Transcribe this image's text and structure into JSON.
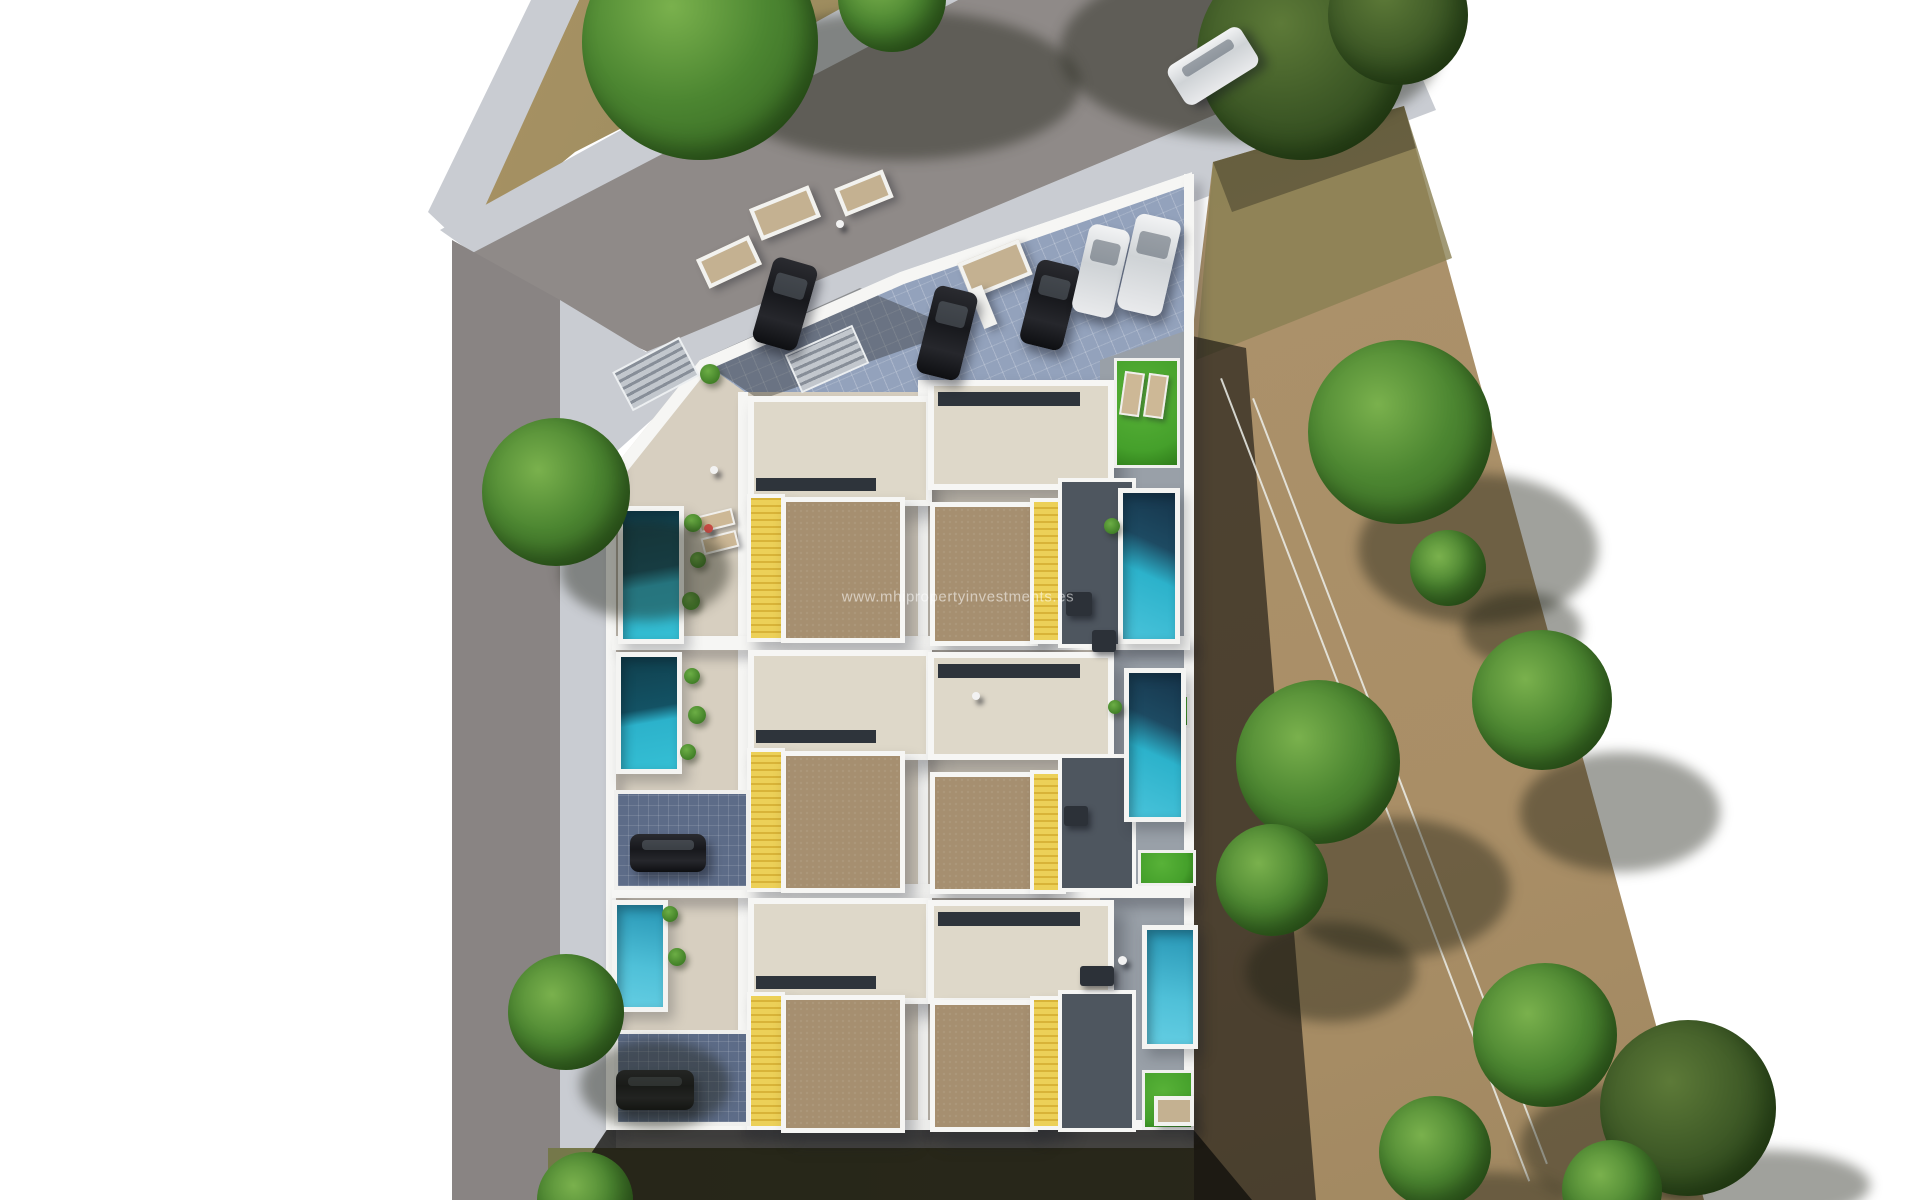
{
  "watermark": {
    "text": "www.mhipropertyinvestments.es"
  },
  "palette": {
    "bg": "#ffffff",
    "sidewalk": "#c9ccd2",
    "road": "#8f8a88",
    "road_dark": "#898483",
    "paving": "#93a2bc",
    "terrace": "#d7cfc0",
    "terrace_light": "#ded8c9",
    "roof_brown": "#a68f70",
    "deck_yellow": "#ecd058",
    "pool_bright": "#2cb2cb",
    "pool_dark": "#10404e",
    "grass": "#45a02b",
    "field": "#ab916a",
    "field_olive": "#8a7f53",
    "tree": "#4c8631",
    "tree_dark": "#2e5a1d",
    "wall": "#f6f6f4",
    "car_dark": "#17181c",
    "car_white": "#e9eaec",
    "watermark_color": "rgba(255,255,255,0.55)"
  },
  "scene": {
    "canvas": {
      "width": 1920,
      "height": 1200
    },
    "items": [
      {
        "n": "dirt-patch-top",
        "c": "dirt",
        "clip": "polygon(579px 0px, 872px 0px, 575px 152px, 468px 240px)"
      },
      {
        "n": "sidewalk-top-left",
        "c": "sidewalk",
        "clip": "polygon(531px 0px, 579px 0px, 466px 248px, 428px 212px)"
      },
      {
        "n": "sidewalk-upper",
        "c": "sidewalk",
        "clip": "polygon(856px 0px, 958px 0px, 480px 258px, 440px 230px)"
      },
      {
        "n": "road-diagonal",
        "c": "road",
        "clip": "polygon(958px 0px, 1396px 0px, 1404px 36px, 648px 352px, 455px 262px)"
      },
      {
        "n": "road-left-vertical",
        "c": "road2",
        "clip": "polygon(452px 240px, 560px 300px, 560px 1200px, 452px 1200px)"
      },
      {
        "n": "sidewalk-lower-diagonal",
        "c": "sidewalk",
        "clip": "polygon(1404px 36px, 1436px 110px, 676px 398px, 646px 352px)"
      },
      {
        "n": "sidewalk-left-vertical",
        "c": "sidewalk",
        "clip": "polygon(560px 300px, 646px 352px, 676px 398px, 616px 452px, 616px 1200px, 560px 1200px)"
      },
      {
        "n": "dirt-field",
        "c": "field",
        "clip": "polygon(1213px 162px, 1404px 106px, 1704px 1200px, 1194px 1200px, 1192px 336px)"
      },
      {
        "n": "field-olive-patch",
        "c": "field-olive",
        "clip": "polygon(1213px 162px, 1404px 106px, 1452px 258px, 1196px 360px)"
      },
      {
        "n": "field-top-shadow",
        "c": "shade",
        "clip": "polygon(1213px 162px, 1404px 106px, 1416px 148px, 1232px 212px)"
      },
      {
        "n": "field-west-wall-shadow",
        "c": "shade-deep",
        "clip": "polygon(1192px 336px, 1246px 348px, 1316px 1200px, 1194px 1200px)"
      },
      {
        "n": "field-fence-line",
        "c": "fence",
        "x": 1222,
        "y": 378,
        "w": 860,
        "h": 2,
        "r": 69
      },
      {
        "n": "field-fence-line",
        "c": "fence",
        "x": 1254,
        "y": 398,
        "w": 820,
        "h": 2,
        "r": 69
      },
      {
        "n": "tree-shadow",
        "c": "tshadow",
        "x": 1060,
        "y": -40,
        "w": 380,
        "h": 180
      },
      {
        "n": "tree-shadow",
        "c": "tshadow",
        "x": 1358,
        "y": 474,
        "w": 240,
        "h": 150
      },
      {
        "n": "tree-shadow",
        "c": "tshadow",
        "x": 1462,
        "y": 592,
        "w": 120,
        "h": 74
      },
      {
        "n": "tree-shadow",
        "c": "tshadow",
        "x": 1280,
        "y": 818,
        "w": 230,
        "h": 140
      },
      {
        "n": "tree-shadow",
        "c": "tshadow",
        "x": 1246,
        "y": 922,
        "w": 170,
        "h": 100
      },
      {
        "n": "tree-shadow",
        "c": "tshadow",
        "x": 1520,
        "y": 752,
        "w": 200,
        "h": 120
      },
      {
        "n": "tree-shadow",
        "c": "tshadow",
        "x": 1520,
        "y": 1086,
        "w": 210,
        "h": 120
      },
      {
        "n": "tree-shadow",
        "c": "tshadow",
        "x": 1410,
        "y": 1172,
        "w": 160,
        "h": 56
      },
      {
        "n": "tree-shadow",
        "c": "tshadow",
        "x": 1660,
        "y": 1150,
        "w": 210,
        "h": 70
      },
      {
        "n": "field-tree",
        "c": "tree darktone",
        "x": 1197,
        "y": -50,
        "w": 210,
        "h": 210
      },
      {
        "n": "field-tree",
        "c": "tree darktone",
        "x": 1328,
        "y": -55,
        "w": 140,
        "h": 140
      },
      {
        "n": "field-tree",
        "c": "tree",
        "x": 1308,
        "y": 340,
        "w": 184,
        "h": 184
      },
      {
        "n": "field-tree",
        "c": "tree",
        "x": 1410,
        "y": 530,
        "w": 76,
        "h": 76
      },
      {
        "n": "field-tree",
        "c": "tree",
        "x": 1236,
        "y": 680,
        "w": 164,
        "h": 164
      },
      {
        "n": "field-tree",
        "c": "tree",
        "x": 1216,
        "y": 824,
        "w": 112,
        "h": 112
      },
      {
        "n": "field-tree",
        "c": "tree",
        "x": 1472,
        "y": 630,
        "w": 140,
        "h": 140
      },
      {
        "n": "field-tree",
        "c": "tree",
        "x": 1473,
        "y": 963,
        "w": 144,
        "h": 144
      },
      {
        "n": "field-tree",
        "c": "tree",
        "x": 1379,
        "y": 1096,
        "w": 112,
        "h": 112
      },
      {
        "n": "field-tree",
        "c": "tree darktone",
        "x": 1600,
        "y": 1020,
        "w": 176,
        "h": 176
      },
      {
        "n": "field-tree",
        "c": "tree",
        "x": 1562,
        "y": 1140,
        "w": 100,
        "h": 100
      },
      {
        "n": "grass-strip-bottom",
        "c": "grassland",
        "clip": "polygon(548px 1148px, 1194px 1148px, 1194px 1200px, 548px 1200px)"
      },
      {
        "n": "complex-south-shadow",
        "c": "shade-strong",
        "clip": "polygon(608px 1128px, 1192px 1128px, 1252px 1200px, 560px 1200px)"
      },
      {
        "n": "complex-plot",
        "c": "terrace-base",
        "clip": "polygon(612px 470px, 700px 360px, 900px 272px, 1192px 172px, 1192px 1130px, 612px 1130px)"
      },
      {
        "n": "parking-paving",
        "c": "paving",
        "clip": "polygon(700px 360px, 900px 272px, 1192px 172px, 1192px 356px, 1100px 392px, 745px 392px)"
      },
      {
        "n": "east-garden-apron",
        "c": "apron",
        "clip": "polygon(1100px 360px, 1188px 330px, 1188px 1126px, 1100px 1126px)"
      },
      {
        "n": "parking-tree-shade",
        "c": "shade",
        "clip": "polygon(700px 360px, 860px 288px, 960px 330px, 760px 400px)"
      },
      {
        "n": "boundary-wall-top",
        "c": "wall-line",
        "clip": "polygon(612px 470px, 700px 360px, 900px 272px, 1192px 172px, 1192px 184px, 904px 284px, 708px 370px, 622px 478px)"
      },
      {
        "n": "stairs",
        "c": "stairs",
        "x": 618,
        "y": 352,
        "w": 72,
        "h": 40,
        "r": -28
      },
      {
        "n": "stairs",
        "c": "stairs",
        "x": 790,
        "y": 338,
        "w": 70,
        "h": 38,
        "r": -24
      },
      {
        "n": "planter",
        "c": "planter",
        "x": 753,
        "y": 196,
        "w": 56,
        "h": 26,
        "r": -22
      },
      {
        "n": "planter",
        "c": "planter",
        "x": 838,
        "y": 178,
        "w": 44,
        "h": 22,
        "r": -22
      },
      {
        "n": "planter",
        "c": "planter",
        "x": 962,
        "y": 250,
        "w": 58,
        "h": 30,
        "r": -22
      },
      {
        "n": "planter",
        "c": "planter",
        "x": 700,
        "y": 246,
        "w": 50,
        "h": 24,
        "r": -25
      },
      {
        "n": "planter-wall",
        "c": "wallbox",
        "x": 976,
        "y": 286,
        "w": 14,
        "h": 42,
        "r": -22
      },
      {
        "n": "wall-outer-left",
        "c": "wall",
        "x": 606,
        "y": 460,
        "w": 10,
        "h": 670
      },
      {
        "n": "wall-divider-west",
        "c": "wall",
        "x": 738,
        "y": 392,
        "w": 10,
        "h": 736
      },
      {
        "n": "wall-divider-center",
        "c": "wall",
        "x": 918,
        "y": 380,
        "w": 10,
        "h": 748
      },
      {
        "n": "wall-outer-right",
        "c": "wall",
        "x": 1184,
        "y": 174,
        "w": 10,
        "h": 956
      },
      {
        "n": "wall-row-divider",
        "c": "wall",
        "x": 612,
        "y": 636,
        "w": 578,
        "h": 14
      },
      {
        "n": "wall-row-divider",
        "c": "wall",
        "x": 612,
        "y": 884,
        "w": 578,
        "h": 14
      },
      {
        "n": "wall-bottom",
        "c": "wall",
        "x": 612,
        "y": 1120,
        "w": 578,
        "h": 10
      },
      {
        "n": "house-terrace",
        "c": "terrace",
        "x": 748,
        "y": 396,
        "w": 172,
        "h": 98
      },
      {
        "n": "stairwell-slot",
        "c": "slot",
        "x": 756,
        "y": 478,
        "w": 120,
        "h": 13
      },
      {
        "n": "deck-yellow",
        "c": "deck",
        "x": 747,
        "y": 494,
        "w": 30,
        "h": 140
      },
      {
        "n": "roof-solarium",
        "c": "roof",
        "x": 781,
        "y": 497,
        "w": 114,
        "h": 136
      },
      {
        "n": "house-terrace",
        "c": "terrace",
        "x": 748,
        "y": 650,
        "w": 172,
        "h": 98
      },
      {
        "n": "stairwell-slot",
        "c": "slot",
        "x": 756,
        "y": 730,
        "w": 120,
        "h": 13
      },
      {
        "n": "deck-yellow",
        "c": "deck",
        "x": 747,
        "y": 748,
        "w": 30,
        "h": 136
      },
      {
        "n": "roof-solarium",
        "c": "roof",
        "x": 781,
        "y": 751,
        "w": 114,
        "h": 132
      },
      {
        "n": "house-terrace",
        "c": "terrace",
        "x": 748,
        "y": 898,
        "w": 172,
        "h": 94
      },
      {
        "n": "stairwell-slot",
        "c": "slot",
        "x": 756,
        "y": 976,
        "w": 120,
        "h": 13
      },
      {
        "n": "deck-yellow",
        "c": "deck",
        "x": 747,
        "y": 992,
        "w": 30,
        "h": 130
      },
      {
        "n": "roof-solarium",
        "c": "roof",
        "x": 781,
        "y": 995,
        "w": 114,
        "h": 128
      },
      {
        "n": "house-terrace",
        "c": "terrace",
        "x": 928,
        "y": 380,
        "w": 174,
        "h": 98
      },
      {
        "n": "stairwell-slot",
        "c": "slot",
        "x": 938,
        "y": 392,
        "w": 142,
        "h": 14
      },
      {
        "n": "roof-solarium",
        "c": "roof",
        "x": 930,
        "y": 502,
        "w": 98,
        "h": 134
      },
      {
        "n": "deck-yellow",
        "c": "deck",
        "x": 1030,
        "y": 498,
        "w": 28,
        "h": 138
      },
      {
        "n": "patio-shaded",
        "c": "patio",
        "x": 1058,
        "y": 478,
        "w": 70,
        "h": 162
      },
      {
        "n": "house-terrace",
        "c": "terrace",
        "x": 928,
        "y": 652,
        "w": 174,
        "h": 96
      },
      {
        "n": "stairwell-slot",
        "c": "slot",
        "x": 938,
        "y": 664,
        "w": 142,
        "h": 14
      },
      {
        "n": "roof-solarium",
        "c": "roof",
        "x": 930,
        "y": 772,
        "w": 98,
        "h": 112
      },
      {
        "n": "deck-yellow",
        "c": "deck",
        "x": 1030,
        "y": 770,
        "w": 28,
        "h": 116
      },
      {
        "n": "patio-shaded",
        "c": "patio",
        "x": 1058,
        "y": 754,
        "w": 70,
        "h": 130
      },
      {
        "n": "house-terrace",
        "c": "terrace",
        "x": 928,
        "y": 900,
        "w": 174,
        "h": 92
      },
      {
        "n": "stairwell-slot",
        "c": "slot",
        "x": 938,
        "y": 912,
        "w": 142,
        "h": 14
      },
      {
        "n": "roof-solarium",
        "c": "roof",
        "x": 930,
        "y": 1000,
        "w": 98,
        "h": 122
      },
      {
        "n": "deck-yellow",
        "c": "deck",
        "x": 1030,
        "y": 996,
        "w": 28,
        "h": 126
      },
      {
        "n": "patio-shaded",
        "c": "patio",
        "x": 1058,
        "y": 990,
        "w": 70,
        "h": 134
      },
      {
        "n": "pool",
        "c": "pool pw",
        "x": 618,
        "y": 506,
        "w": 56,
        "h": 128
      },
      {
        "n": "pool",
        "c": "pool pw",
        "x": 616,
        "y": 652,
        "w": 56,
        "h": 112
      },
      {
        "n": "driveway",
        "c": "paving-dark",
        "x": 614,
        "y": 790,
        "w": 128,
        "h": 92
      },
      {
        "n": "parked-car",
        "c": "car dark",
        "x": 630,
        "y": 834,
        "w": 76,
        "h": 38
      },
      {
        "n": "pool",
        "c": "pool pl",
        "x": 612,
        "y": 900,
        "w": 46,
        "h": 102
      },
      {
        "n": "driveway",
        "c": "paving-dark",
        "x": 614,
        "y": 1030,
        "w": 128,
        "h": 88
      },
      {
        "n": "parked-car",
        "c": "car dark",
        "x": 616,
        "y": 1070,
        "w": 78,
        "h": 40
      },
      {
        "n": "garden-grass",
        "c": "grass",
        "x": 1114,
        "y": 358,
        "w": 60,
        "h": 104
      },
      {
        "n": "lounger",
        "c": "lounger",
        "x": 1122,
        "y": 372,
        "w": 16,
        "h": 40,
        "r": 8
      },
      {
        "n": "lounger",
        "c": "lounger",
        "x": 1146,
        "y": 374,
        "w": 16,
        "h": 40,
        "r": 8
      },
      {
        "n": "pool",
        "c": "pool pe",
        "x": 1118,
        "y": 488,
        "w": 52,
        "h": 146
      },
      {
        "n": "garden-grass",
        "c": "grass",
        "x": 1148,
        "y": 694,
        "w": 36,
        "h": 28
      },
      {
        "n": "pool",
        "c": "pool pe",
        "x": 1124,
        "y": 668,
        "w": 52,
        "h": 144
      },
      {
        "n": "garden-grass",
        "c": "grass",
        "x": 1138,
        "y": 850,
        "w": 52,
        "h": 30
      },
      {
        "n": "pool",
        "c": "pool pl",
        "x": 1142,
        "y": 925,
        "w": 46,
        "h": 114
      },
      {
        "n": "garden-grass",
        "c": "grass",
        "x": 1142,
        "y": 1070,
        "w": 46,
        "h": 54
      },
      {
        "n": "paver-pad",
        "c": "planter",
        "x": 1154,
        "y": 1096,
        "w": 32,
        "h": 22
      },
      {
        "n": "patio-furniture",
        "c": "furn",
        "x": 1066,
        "y": 592,
        "w": 26,
        "h": 24
      },
      {
        "n": "patio-furniture",
        "c": "furn",
        "x": 1092,
        "y": 630,
        "w": 24,
        "h": 22
      },
      {
        "n": "patio-furniture",
        "c": "furn",
        "x": 1064,
        "y": 806,
        "w": 24,
        "h": 20
      },
      {
        "n": "patio-furniture",
        "c": "furn",
        "x": 1080,
        "y": 966,
        "w": 34,
        "h": 20
      },
      {
        "n": "lounger",
        "c": "lounger",
        "x": 698,
        "y": 512,
        "w": 32,
        "h": 13,
        "r": -14
      },
      {
        "n": "lounger",
        "c": "lounger",
        "x": 702,
        "y": 534,
        "w": 32,
        "h": 13,
        "r": -14
      },
      {
        "n": "shrub",
        "c": "shrub",
        "x": 684,
        "y": 514,
        "w": 18,
        "h": 18
      },
      {
        "n": "shrub",
        "c": "shrub",
        "x": 690,
        "y": 552,
        "w": 16,
        "h": 16
      },
      {
        "n": "shrub",
        "c": "shrub",
        "x": 682,
        "y": 592,
        "w": 18,
        "h": 18
      },
      {
        "n": "shrub",
        "c": "shrub",
        "x": 684,
        "y": 668,
        "w": 16,
        "h": 16
      },
      {
        "n": "shrub",
        "c": "shrub",
        "x": 688,
        "y": 706,
        "w": 18,
        "h": 18
      },
      {
        "n": "shrub",
        "c": "shrub",
        "x": 680,
        "y": 744,
        "w": 16,
        "h": 16
      },
      {
        "n": "shrub",
        "c": "shrub",
        "x": 662,
        "y": 906,
        "w": 16,
        "h": 16
      },
      {
        "n": "shrub",
        "c": "shrub",
        "x": 668,
        "y": 948,
        "w": 18,
        "h": 18
      },
      {
        "n": "shrub",
        "c": "shrub",
        "x": 700,
        "y": 364,
        "w": 20,
        "h": 20
      },
      {
        "n": "shrub",
        "c": "shrub",
        "x": 1104,
        "y": 518,
        "w": 16,
        "h": 16
      },
      {
        "n": "shrub",
        "c": "shrub",
        "x": 1108,
        "y": 700,
        "w": 14,
        "h": 14
      },
      {
        "n": "parked-car",
        "c": "car dark",
        "x": 762,
        "y": 260,
        "w": 46,
        "h": 88,
        "r": 16
      },
      {
        "n": "parked-car",
        "c": "car dark",
        "x": 925,
        "y": 288,
        "w": 44,
        "h": 90,
        "r": 14
      },
      {
        "n": "parked-car",
        "c": "car dark",
        "x": 1028,
        "y": 262,
        "w": 44,
        "h": 86,
        "r": 14
      },
      {
        "n": "parked-car",
        "c": "car white",
        "x": 1080,
        "y": 226,
        "w": 42,
        "h": 90,
        "r": 13
      },
      {
        "n": "parked-car",
        "c": "car white",
        "x": 1126,
        "y": 216,
        "w": 46,
        "h": 98,
        "r": 13
      },
      {
        "n": "driving-car",
        "c": "car white",
        "x": 1170,
        "y": 43,
        "w": 86,
        "h": 46,
        "r": -32
      },
      {
        "n": "person",
        "c": "person",
        "x": 836,
        "y": 220,
        "w": 8,
        "h": 8
      },
      {
        "n": "person",
        "c": "person",
        "x": 710,
        "y": 466,
        "w": 8,
        "h": 8
      },
      {
        "n": "person",
        "c": "person red",
        "x": 704,
        "y": 524,
        "w": 9,
        "h": 9
      },
      {
        "n": "person",
        "c": "person",
        "x": 972,
        "y": 692,
        "w": 8,
        "h": 8
      },
      {
        "n": "person",
        "c": "person",
        "x": 1118,
        "y": 956,
        "w": 9,
        "h": 9
      },
      {
        "n": "tree-shadow",
        "c": "tshadow",
        "x": 720,
        "y": 10,
        "w": 360,
        "h": 150
      },
      {
        "n": "street-tree",
        "c": "tree",
        "x": 582,
        "y": -76,
        "w": 236,
        "h": 236
      },
      {
        "n": "street-tree",
        "c": "tree",
        "x": 838,
        "y": -56,
        "w": 108,
        "h": 108
      },
      {
        "n": "tree-shadow",
        "c": "tshadow",
        "x": 560,
        "y": 520,
        "w": 170,
        "h": 100
      },
      {
        "n": "street-tree",
        "c": "tree",
        "x": 482,
        "y": 418,
        "w": 148,
        "h": 148
      },
      {
        "n": "tree-shadow",
        "c": "tshadow",
        "x": 580,
        "y": 1040,
        "w": 150,
        "h": 90
      },
      {
        "n": "street-tree",
        "c": "tree",
        "x": 508,
        "y": 954,
        "w": 116,
        "h": 116
      },
      {
        "n": "street-tree",
        "c": "tree",
        "x": 537,
        "y": 1152,
        "w": 96,
        "h": 96
      }
    ]
  }
}
